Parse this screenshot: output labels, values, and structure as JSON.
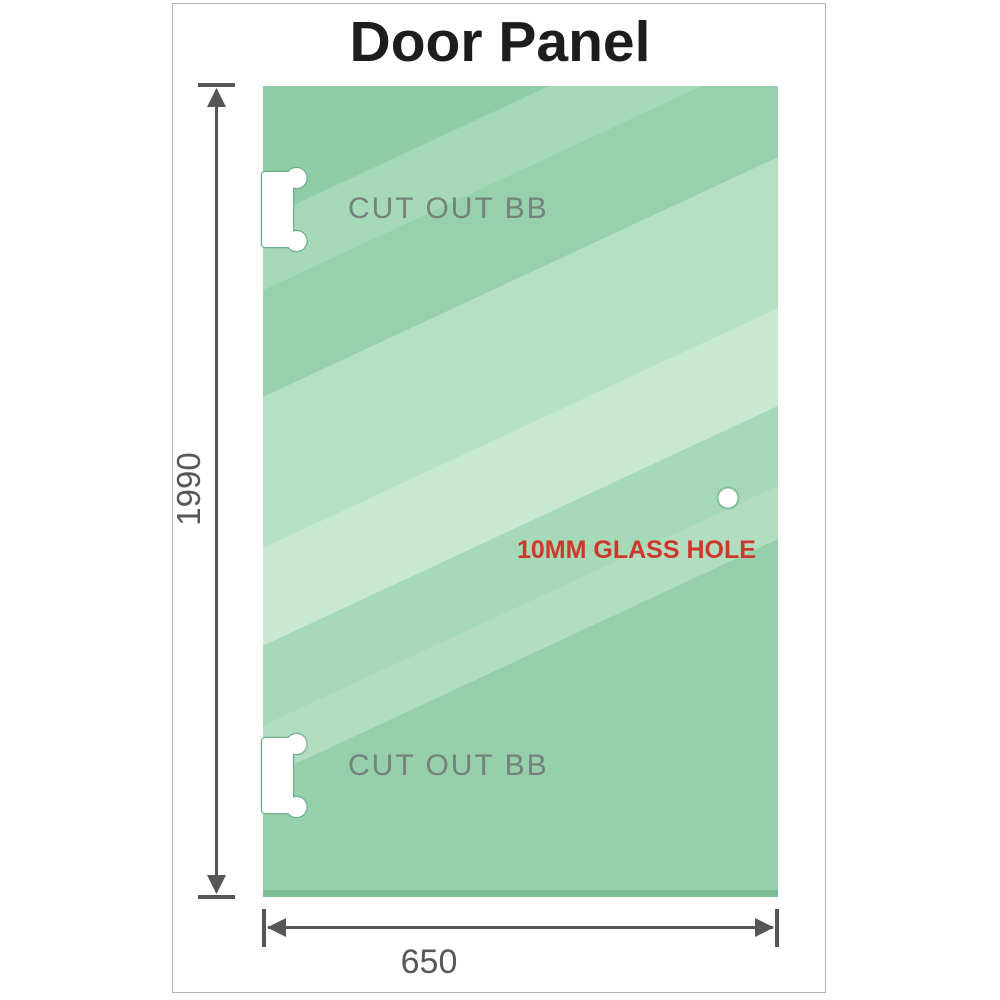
{
  "title": "Door Panel",
  "diagram": {
    "height_dimension": "1990",
    "width_dimension": "650",
    "cutout_top": {
      "label": "CUT OUT BB"
    },
    "cutout_bottom": {
      "label": "CUT OUT BB"
    },
    "glass_hole": {
      "label": "10MM GLASS HOLE"
    }
  },
  "colors": {
    "glass_green_base": "#8ecda6",
    "glass_green_band_light": "#b6e0c5",
    "glass_green_band_lighter": "#c8e8d3",
    "glass_bottom_edge": "#7abd95",
    "cutout_outline_green": "#6fae8c",
    "dimension_gray": "#565656",
    "cutout_label_gray": "#76817c",
    "glass_hole_label_red": "#cd382b",
    "title_black": "#1d1d1d",
    "frame_border_gray": "#b4b4b4"
  }
}
